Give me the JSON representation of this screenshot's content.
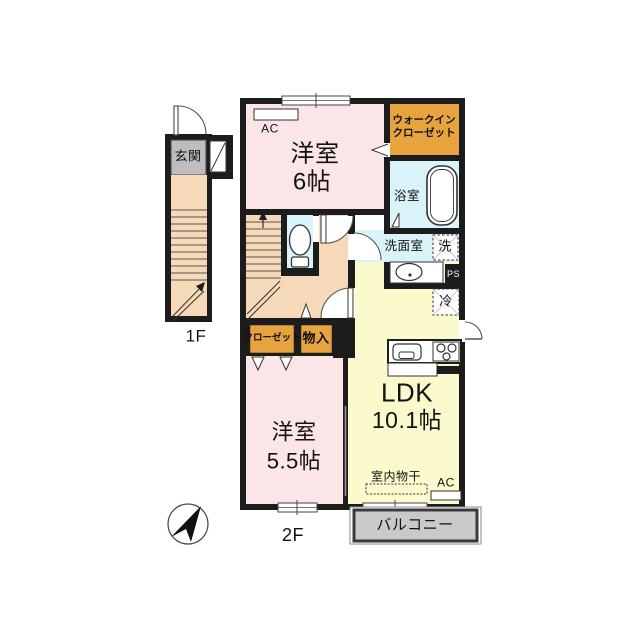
{
  "plan": {
    "floor1": {
      "label": "1F",
      "entrance": "玄関"
    },
    "floor2": {
      "label": "2F",
      "bedroom6": {
        "name": "洋室",
        "size": "6帖"
      },
      "wic_line1": "ウォークイン",
      "wic_line2": "クローゼット",
      "bath": "浴室",
      "washroom": "洗面室",
      "washer": "洗",
      "ps": "PS",
      "fridge": "冷",
      "ldk": {
        "name": "LDK",
        "size": "10.1帖"
      },
      "bedroom55": {
        "name": "洋室",
        "size": "5.5帖"
      },
      "closet": "クローゼット",
      "storage": "物入",
      "indoor_drying": "室内物干",
      "ac": "AC",
      "balcony": "バルコニー"
    }
  },
  "colors": {
    "wall": "#1c1c1c",
    "pink": "#fbe5e7",
    "peach": "#f6d9b8",
    "cyan": "#d9f3f8",
    "orange": "#e6a33e",
    "yellow": "#fafacd",
    "gray_genkan": "#bdbdbd",
    "gray_balcony": "#c9c9c9",
    "line": "#333333"
  }
}
